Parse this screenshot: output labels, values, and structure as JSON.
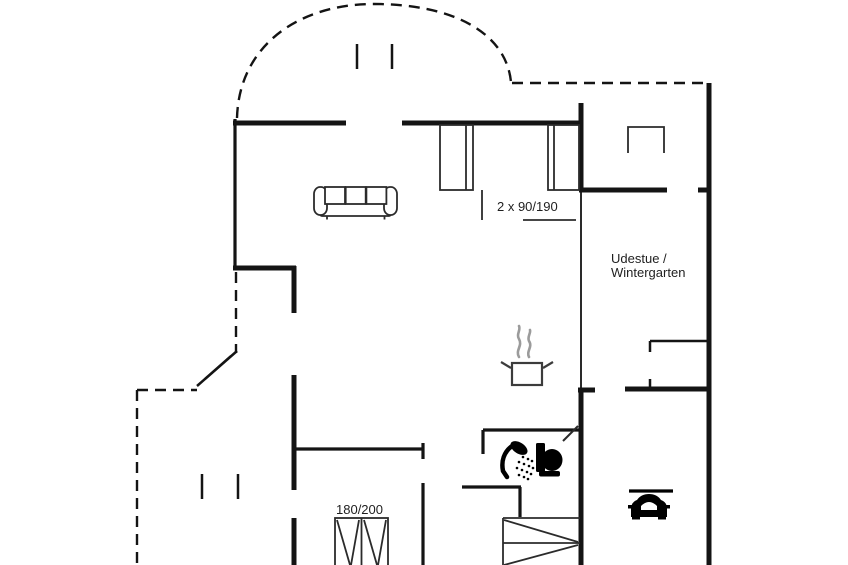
{
  "plan": {
    "title": "holiday-house-floor-plan",
    "labels": {
      "beds_top": "2 x 90/190",
      "room_right_line1": "Udestue /",
      "room_right_line2": "Wintergarten",
      "bed_bottom": "180/200"
    },
    "icons": {
      "sofa": "sofa-icon",
      "pot": "cooking-pot-icon",
      "steam": "steam-icon",
      "shower": "shower-icon",
      "toilet": "toilet-icon",
      "car": "car-icon",
      "stairs": "stairs-icon",
      "double_bed": "double-bed-icon",
      "single_beds": "single-beds-icon",
      "wardrobe": "wardrobe-icon"
    },
    "colors": {
      "wall": "#141414",
      "background": "#ffffff",
      "steam": "#9b9b9b",
      "pot_outline": "#3c3c3c"
    }
  }
}
